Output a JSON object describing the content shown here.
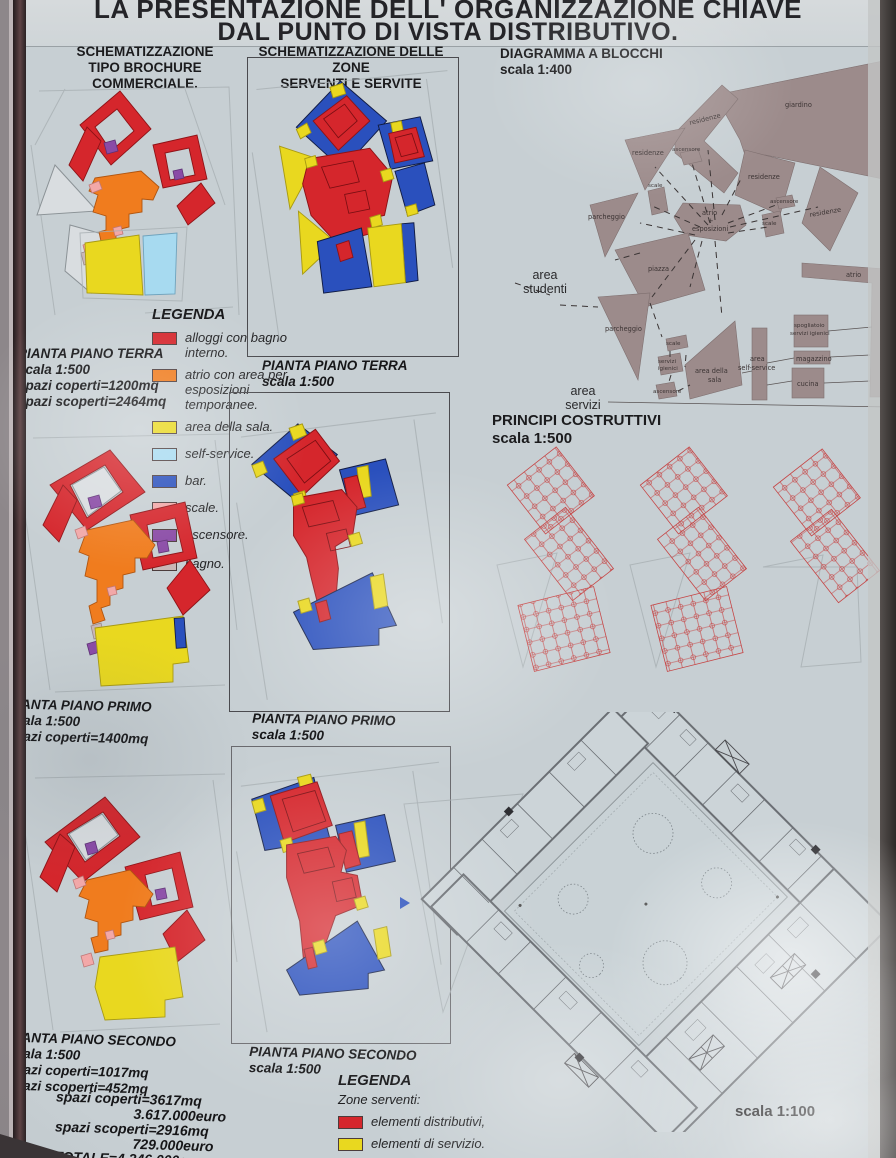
{
  "poster": {
    "title_line1": "LA PRESENTAZIONE DELL' ORGANIZZAZIONE CHIAVE",
    "title_line2": "DAL PUNTO DI VISTA DISTRIBUTIVO."
  },
  "col_brochure": {
    "header_line1": "SCHEMATIZZAZIONE",
    "header_line2": "TIPO BROCHURE COMMERCIALE.",
    "terra": {
      "title": "PIANTA PIANO TERRA",
      "scale": "scala 1:500",
      "coperti": "spazi coperti=1200mq",
      "scoperti": "spazi scoperti=2464mq"
    },
    "primo": {
      "title": "PIANTA PIANO PRIMO",
      "scale": "scala 1:500",
      "coperti": "spazi coperti=1400mq"
    },
    "secondo": {
      "title": "PIANTA PIANO SECONDO",
      "scale": "scala 1:500",
      "coperti": "spazi coperti=1017mq",
      "scoperti": "spazi scoperti=452mq"
    },
    "totals": {
      "line1": "spazi coperti=3617mq",
      "line2": "3.617.000euro",
      "line3": "spazi scoperti=2916mq",
      "line4": "729.000euro",
      "line5": "TOTALE=4.346.000euro"
    }
  },
  "legend_main": {
    "title": "LEGENDA",
    "items": [
      {
        "label": "alloggi con bagno interno.",
        "color": "#d5262c"
      },
      {
        "label": "atrio con area per esposizioni temporanee.",
        "color": "#f07c1e"
      },
      {
        "label": "area della sala.",
        "color": "#e9d81f"
      },
      {
        "label": "self-service.",
        "color": "#a7daf0"
      },
      {
        "label": "bar.",
        "color": "#2a50bd"
      },
      {
        "label": "scale.",
        "color": "#f2a8a8"
      },
      {
        "label": "ascensore.",
        "color": "#8a4ba6"
      },
      {
        "label": "bagno.",
        "color": "#c9b7b7"
      }
    ]
  },
  "col_zone": {
    "header_line1": "SCHEMATIZZAZIONE DELLE ZONE",
    "header_line2": "SERVENTI E SERVITE",
    "terra": {
      "title": "PIANTA PIANO TERRA",
      "scale": "scala 1:500"
    },
    "primo": {
      "title": "PIANTA PIANO PRIMO",
      "scale": "scala 1:500"
    },
    "secondo": {
      "title": "PIANTA PIANO SECONDO",
      "scale": "scala 1:500"
    },
    "legend": {
      "title": "LEGENDA",
      "serventi_label": "Zone serventi:",
      "items": [
        {
          "label": "elementi distributivi,",
          "color": "#d5262c"
        },
        {
          "label": "elementi di servizio.",
          "color": "#e9d81f"
        }
      ],
      "servite_label": "Zone servite:"
    }
  },
  "col_blocks": {
    "header_line1": "DIAGRAMMA A BLOCCHI",
    "header_line2": "scala 1:400",
    "labels": [
      "giardino",
      "residenze",
      "ascensore",
      "residenze",
      "residenze",
      "ascensore",
      "residenze",
      "scale",
      "parcheggio",
      "atrio",
      "+",
      "esposizioni",
      "scale",
      "piazza",
      "parcheggio",
      "scale",
      "servizi",
      "igienici",
      "ascensore",
      "area della",
      "sala",
      "area",
      "self-service",
      "spogliatoio",
      "servizi igienici",
      "magazzino",
      "cucina",
      "atrio"
    ],
    "area_studenti": {
      "line1": "area",
      "line2": "studenti"
    },
    "area_servizi": {
      "line1": "area",
      "line2": "servizi"
    }
  },
  "principi": {
    "title": "PRINCIPI COSTRUTTIVI",
    "scale": "scala 1:500"
  },
  "plan_100": {
    "scale_label": "scala 1:100"
  }
}
